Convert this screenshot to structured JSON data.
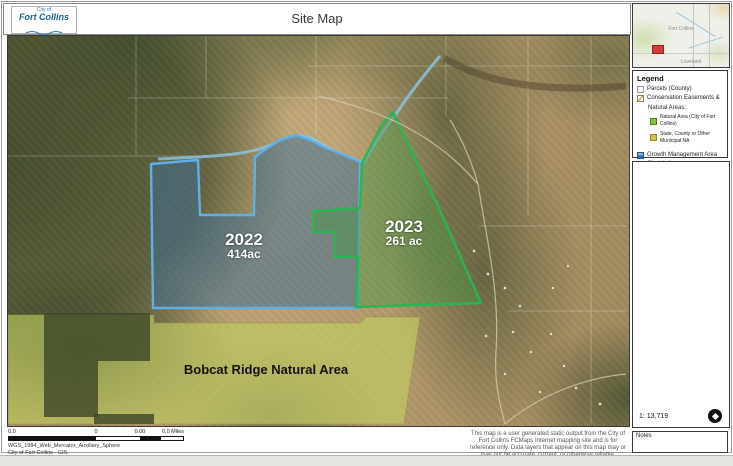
{
  "header": {
    "title": "Site Map"
  },
  "logo": {
    "city_of": "City of",
    "name": "Fort Collins"
  },
  "inset": {
    "city": "Fort Collins",
    "town": "Loveland",
    "marker_color": "#d43c3c"
  },
  "legend": {
    "title": "Legend",
    "items": [
      {
        "label": "Parcels (County)",
        "swatch": "parcels-outline"
      },
      {
        "label": "Conservation Easements &",
        "swatch": "easement-hatch"
      },
      {
        "label": "Natural Areas:",
        "swatch": "none"
      },
      {
        "label": "Natural Area (City of Fort Collins)",
        "swatch": "green"
      },
      {
        "label": "State, County or Other Municipal NA",
        "swatch": "olive"
      },
      {
        "label": "Growth Management Area",
        "swatch": "blue"
      },
      {
        "label": "City Limits",
        "swatch": "light-blue-line"
      }
    ],
    "scale_text": "1: 13,719"
  },
  "map": {
    "labels": {
      "easement_2022_year": "2022",
      "easement_2022_area": "414ac",
      "easement_2023_year": "2023",
      "easement_2023_area": "261 ac",
      "natural_area": "Bobcat Ridge Natural Area"
    },
    "colors": {
      "easement_2022_outline": "#5fb0e8",
      "easement_2023_outline": "#29b552",
      "natural_area_fill": "#c3ce62"
    }
  },
  "footer": {
    "scalebar_labels": [
      "0.0",
      "0",
      "0.00",
      "0.0 Miles"
    ],
    "projection": "WGS_1984_Web_Mercator_Auxiliary_Sphere",
    "credit": "City of Fort Collins - GIS",
    "disclaimer": "This map is a user generated static output from the City of Fort Collins FCMaps Internet mapping site and is for reference only. Data layers that appear on this map may or may not be accurate, current, or otherwise reliable.",
    "notes_label": "Notes"
  }
}
